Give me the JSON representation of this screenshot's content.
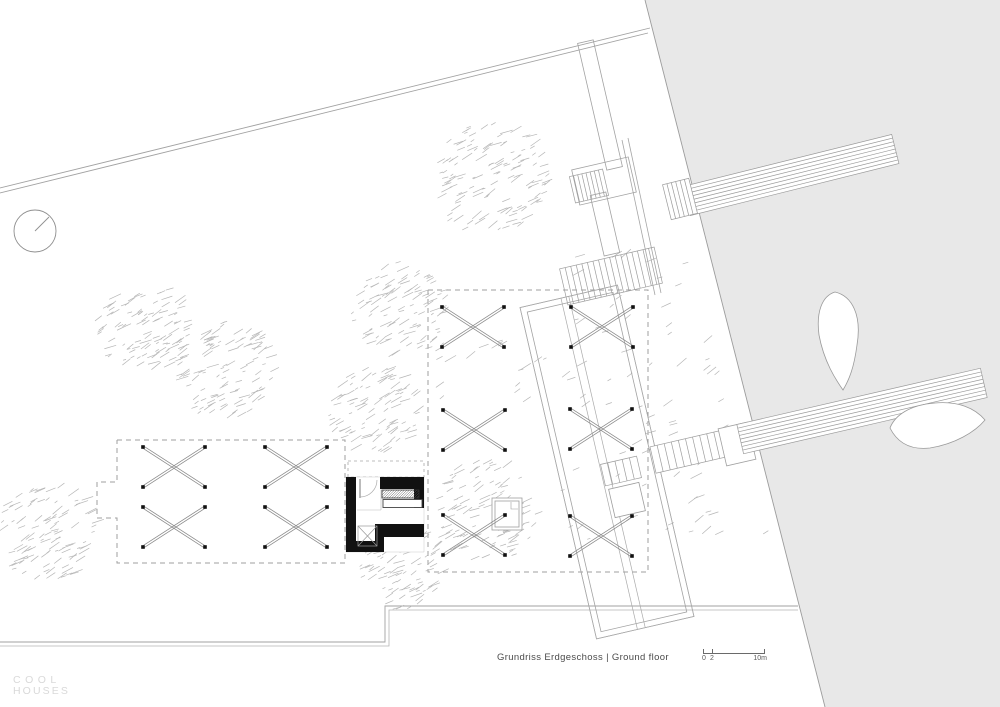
{
  "texts": {
    "caption": "Grundriss Erdgeschoss | Ground floor",
    "logo_line1": "COOL",
    "logo_line2": "HOUSES"
  },
  "scalebar": {
    "labels": [
      "0",
      "2",
      "10m"
    ]
  },
  "colors": {
    "paper": "#ffffff",
    "water": "#e8e8e8",
    "boundary": "#a2a2a2",
    "detail": "#a0a0a0",
    "dashed_zone": "#9f9f9f",
    "tree_hatch": "#b6b6b6",
    "wall_black": "#111111",
    "marker": "#8a8a8a",
    "marker_dot": "#111111",
    "caption_text": "#4b4b4b",
    "logo_text": "#d9d9d9",
    "scale_text": "#5a5a5a"
  },
  "plan": {
    "width": 1000,
    "height": 707,
    "shapes": [
      {
        "name": "water-area",
        "type": "poly",
        "pts": [
          [
            645,
            0
          ],
          [
            1000,
            0
          ],
          [
            1000,
            707
          ],
          [
            825,
            707
          ]
        ],
        "fill": "#e8e8e8",
        "stroke": "none"
      },
      {
        "name": "water-edge",
        "type": "line",
        "x1": 645,
        "y1": 0,
        "x2": 825,
        "y2": 707,
        "stroke": "#9c9c9c",
        "sw": 0.9
      },
      {
        "name": "site-boundary-top-outer",
        "type": "line",
        "x1": 0,
        "y1": 188,
        "x2": 650,
        "y2": 28,
        "stroke": "#a2a2a2",
        "sw": 0.9
      },
      {
        "name": "site-boundary-top-inner",
        "type": "line",
        "x1": 0,
        "y1": 193,
        "x2": 648,
        "y2": 33,
        "stroke": "#a2a2a2",
        "sw": 0.9
      },
      {
        "name": "site-boundary-bottom-outer",
        "type": "pline",
        "pts": [
          [
            0,
            642
          ],
          [
            385,
            642
          ],
          [
            385,
            606
          ],
          [
            798,
            606
          ]
        ],
        "stroke": "#a2a2a2",
        "sw": 0.9
      },
      {
        "name": "site-boundary-bottom-inner",
        "type": "pline",
        "pts": [
          [
            0,
            646
          ],
          [
            389,
            646
          ],
          [
            389,
            610
          ],
          [
            798,
            610
          ]
        ],
        "stroke": "#b5b5b5",
        "sw": 0.8
      },
      {
        "name": "terrace-zone-west-dashed",
        "type": "pline",
        "pts": [
          [
            117,
            440
          ],
          [
            345,
            440
          ],
          [
            345,
            563
          ],
          [
            117,
            563
          ],
          [
            117,
            518
          ],
          [
            97,
            518
          ],
          [
            97,
            482
          ],
          [
            117,
            482
          ],
          [
            117,
            440
          ]
        ],
        "stroke": "#9f9f9f",
        "sw": 1,
        "dash": "5,4"
      },
      {
        "name": "terrace-zone-east-dashed",
        "type": "pline",
        "pts": [
          [
            428,
            290
          ],
          [
            648,
            290
          ],
          [
            648,
            572
          ],
          [
            428,
            572
          ],
          [
            428,
            290
          ]
        ],
        "stroke": "#9f9f9f",
        "sw": 1,
        "dash": "5,4"
      },
      {
        "name": "canopy-dashed",
        "type": "pline",
        "pts": [
          [
            348,
            461
          ],
          [
            424,
            461
          ],
          [
            424,
            477
          ],
          [
            348,
            477
          ],
          [
            348,
            461
          ]
        ],
        "stroke": "#a8a8a8",
        "sw": 0.8,
        "dash": "3,3"
      },
      {
        "name": "tree",
        "type": "tree",
        "cx": 488,
        "cy": 180,
        "r": 58,
        "seed": 11,
        "n": 130
      },
      {
        "name": "tree",
        "type": "tree",
        "cx": 140,
        "cy": 328,
        "r": 46,
        "seed": 22,
        "n": 100
      },
      {
        "name": "tree",
        "type": "tree",
        "cx": 222,
        "cy": 370,
        "r": 50,
        "seed": 33,
        "n": 110
      },
      {
        "name": "tree",
        "type": "tree",
        "cx": 398,
        "cy": 310,
        "r": 48,
        "seed": 44,
        "n": 100
      },
      {
        "name": "tree",
        "type": "tree",
        "cx": 372,
        "cy": 412,
        "r": 45,
        "seed": 55,
        "n": 95
      },
      {
        "name": "tree",
        "type": "tree",
        "cx": 45,
        "cy": 532,
        "r": 50,
        "seed": 66,
        "n": 105
      },
      {
        "name": "tree",
        "type": "tree",
        "cx": 400,
        "cy": 570,
        "r": 42,
        "seed": 77,
        "n": 85
      },
      {
        "name": "tree",
        "type": "tree",
        "cx": 483,
        "cy": 513,
        "r": 52,
        "seed": 88,
        "n": 105
      },
      {
        "name": "slope-hatch",
        "type": "scatter",
        "x": 560,
        "y": 250,
        "w": 230,
        "h": 290,
        "seed": 99,
        "n": 110,
        "clip": [
          645,
          0.2546,
          6
        ]
      },
      {
        "name": "ground-hatch",
        "type": "scatter",
        "x": 430,
        "y": 335,
        "w": 120,
        "h": 70,
        "seed": 17,
        "n": 18
      },
      {
        "name": "retaining-line",
        "type": "line",
        "x1": 622,
        "y1": 140,
        "x2": 655,
        "y2": 295,
        "stroke": "#a5a5a5",
        "sw": 0.8
      },
      {
        "name": "retaining-line",
        "type": "line",
        "x1": 628,
        "y1": 138,
        "x2": 661,
        "y2": 293,
        "stroke": "#a5a5a5",
        "sw": 0.8
      },
      {
        "name": "walkway-upper",
        "type": "rect",
        "cx": 600,
        "cy": 105,
        "w": 16,
        "h": 130,
        "rot": -13,
        "stroke": "#a2a2a2",
        "sw": 0.8
      },
      {
        "name": "stair-landing-north",
        "type": "rect",
        "cx": 604,
        "cy": 181,
        "w": 58,
        "h": 36,
        "rot": -13,
        "stroke": "#a2a2a2",
        "sw": 0.8
      },
      {
        "name": "stair-flight-north",
        "type": "stairs",
        "cx": 589,
        "cy": 186,
        "w": 34,
        "h": 27,
        "rot": -13,
        "treads": 8,
        "stroke": "#9d9d9d",
        "sw": 0.7
      },
      {
        "name": "walkway-mid",
        "type": "rect",
        "cx": 605,
        "cy": 224,
        "w": 16,
        "h": 62,
        "rot": -13,
        "stroke": "#a2a2a2",
        "sw": 0.8
      },
      {
        "name": "stair-flight-main",
        "type": "stairs",
        "cx": 611,
        "cy": 276,
        "w": 97,
        "h": 37,
        "rot": -13,
        "treads": 17,
        "stroke": "#9d9d9d",
        "sw": 0.7
      },
      {
        "name": "deck-outline",
        "type": "rect",
        "cx": 607,
        "cy": 462,
        "w": 100,
        "h": 340,
        "rot": -13,
        "inset": 6,
        "stroke": "#a2a2a2",
        "sw": 0.8
      },
      {
        "name": "deck-walkway-lines",
        "type": "pierv",
        "cx": 607,
        "cy": 462,
        "w": 100,
        "h": 340,
        "rot": -13,
        "offs": [
          -8,
          0
        ],
        "stroke": "#aaaaaa",
        "sw": 0.7
      },
      {
        "name": "stair-flight-pier",
        "type": "stairs",
        "cx": 692,
        "cy": 451,
        "w": 80,
        "h": 27,
        "rot": -13,
        "treads": 11,
        "fill": "#ffffff",
        "stroke": "#9d9d9d",
        "sw": 0.7
      },
      {
        "name": "pier-landing",
        "type": "rect",
        "cx": 737,
        "cy": 444,
        "w": 30,
        "h": 38,
        "rot": -13,
        "fill": "#ffffff",
        "stroke": "#a0a0a0",
        "sw": 0.8
      },
      {
        "name": "pier-south",
        "type": "pier",
        "cx": 862,
        "cy": 411,
        "w": 250,
        "h": 30,
        "rot": -13,
        "lines": 7,
        "fill": "#ffffff",
        "stroke": "#9a9a9a",
        "sw": 0.7
      },
      {
        "name": "pier-north",
        "type": "pier",
        "cx": 791,
        "cy": 175,
        "w": 215,
        "h": 30,
        "rot": -14,
        "lines": 7,
        "fill": "#ffffff",
        "stroke": "#9a9a9a",
        "sw": 0.7
      },
      {
        "name": "gangway",
        "type": "stairs",
        "cx": 680,
        "cy": 199,
        "w": 27,
        "h": 36,
        "rot": -14,
        "treads": 6,
        "fill": "#ffffff",
        "stroke": "#9a9a9a",
        "sw": 0.7
      },
      {
        "name": "stair-flight-small",
        "type": "stairs",
        "cx": 621,
        "cy": 471,
        "w": 37,
        "h": 22,
        "rot": -13,
        "treads": 5,
        "stroke": "#9d9d9d",
        "sw": 0.7
      },
      {
        "name": "pavilion-square",
        "type": "rect",
        "cx": 627,
        "cy": 500,
        "w": 31,
        "h": 29,
        "rot": -13,
        "fill": "#ffffff",
        "stroke": "#9d9d9d",
        "sw": 0.8
      },
      {
        "name": "boat",
        "type": "path",
        "d": "M835,292 C852,296 862,315 857,345 C854,368 849,380 843,390 C836,380 824,362 819,335 C816,312 822,296 835,292 Z",
        "fill": "#ffffff",
        "stroke": "#9a9a9a",
        "sw": 0.8
      },
      {
        "name": "boat",
        "type": "path",
        "d": "M890,428 C895,415 910,405 935,403 C958,401 975,408 985,420 C975,432 955,444 930,448 C912,450 898,444 890,428 Z",
        "fill": "#ffffff",
        "stroke": "#9a9a9a",
        "sw": 0.8
      },
      {
        "name": "kiosk-floor",
        "type": "poly",
        "pts": [
          [
            346,
            477
          ],
          [
            424,
            477
          ],
          [
            424,
            552
          ],
          [
            346,
            552
          ]
        ],
        "fill": "#ffffff",
        "stroke": "#c9c9c9",
        "sw": 0.5
      },
      {
        "name": "small-pavilion",
        "type": "rect",
        "cx": 507,
        "cy": 514,
        "w": 30,
        "h": 32,
        "rot": 0,
        "inset": 3,
        "fill": "#ffffff",
        "stroke": "#9d9d9d",
        "sw": 0.8
      },
      {
        "name": "small-pavilion-notch",
        "type": "pline",
        "pts": [
          [
            511,
            502
          ],
          [
            511,
            509
          ],
          [
            518,
            509
          ]
        ],
        "stroke": "#9d9d9d",
        "sw": 0.6
      },
      {
        "name": "kiosk-wall-left",
        "type": "rect",
        "cx": 351,
        "cy": 514.5,
        "w": 10,
        "h": 75,
        "rot": 0,
        "fill": "#111111",
        "stroke": "none"
      },
      {
        "name": "kiosk-wall-top",
        "type": "rect",
        "cx": 402,
        "cy": 483,
        "w": 44,
        "h": 12,
        "rot": 0,
        "fill": "#111111",
        "stroke": "none"
      },
      {
        "name": "kiosk-wall-right",
        "type": "rect",
        "cx": 419,
        "cy": 492.5,
        "w": 10,
        "h": 31,
        "rot": 0,
        "fill": "#111111",
        "stroke": "none"
      },
      {
        "name": "kiosk-wall-L-horiz",
        "type": "rect",
        "cx": 399.5,
        "cy": 530.5,
        "w": 49,
        "h": 13,
        "rot": 0,
        "fill": "#111111",
        "stroke": "none"
      },
      {
        "name": "kiosk-wall-L-vert",
        "type": "rect",
        "cx": 379.5,
        "cy": 538,
        "w": 9,
        "h": 28,
        "rot": 0,
        "fill": "#111111",
        "stroke": "none"
      },
      {
        "name": "kiosk-wall-bottom",
        "type": "rect",
        "cx": 365,
        "cy": 546.5,
        "w": 38,
        "h": 11,
        "rot": 0,
        "fill": "#111111",
        "stroke": "none"
      },
      {
        "name": "kiosk-counter-hatched",
        "type": "hrect",
        "x": 382,
        "y": 490,
        "w": 37,
        "h": 8,
        "stroke": "#555555",
        "sw": 0.5
      },
      {
        "name": "kiosk-counter",
        "type": "rect",
        "cx": 402.5,
        "cy": 503.5,
        "w": 39,
        "h": 8,
        "rot": 0,
        "fill": "#ffffff",
        "stroke": "#444444",
        "sw": 0.9
      },
      {
        "name": "kiosk-shaft",
        "type": "rectx",
        "cx": 367.5,
        "cy": 536,
        "w": 19,
        "h": 20,
        "stroke": "#999999",
        "sw": 0.7
      },
      {
        "name": "kiosk-door-leaf",
        "type": "line",
        "x1": 360,
        "y1": 479,
        "x2": 360,
        "y2": 498,
        "stroke": "#777777",
        "sw": 1
      },
      {
        "name": "kiosk-door-swing",
        "type": "path",
        "d": "M377,480 A17,17 0 0 1 360,497",
        "fill": "none",
        "stroke": "#ababab",
        "sw": 0.7
      },
      {
        "name": "kiosk-interior-line",
        "type": "line",
        "x1": 357,
        "y1": 510,
        "x2": 381,
        "y2": 510,
        "stroke": "#bbbbbb",
        "sw": 0.6
      },
      {
        "name": "kiosk-interior-line",
        "type": "line",
        "x1": 381,
        "y1": 489,
        "x2": 381,
        "y2": 510,
        "stroke": "#bbbbbb",
        "sw": 0.6
      },
      {
        "name": "shade-marker",
        "type": "x",
        "cx": 174,
        "cy": 467
      },
      {
        "name": "shade-marker",
        "type": "x",
        "cx": 296,
        "cy": 467
      },
      {
        "name": "shade-marker",
        "type": "x",
        "cx": 174,
        "cy": 527
      },
      {
        "name": "shade-marker",
        "type": "x",
        "cx": 296,
        "cy": 527
      },
      {
        "name": "shade-marker",
        "type": "x",
        "cx": 473,
        "cy": 327
      },
      {
        "name": "shade-marker",
        "type": "x",
        "cx": 602,
        "cy": 327
      },
      {
        "name": "shade-marker",
        "type": "x",
        "cx": 474,
        "cy": 430
      },
      {
        "name": "shade-marker",
        "type": "x",
        "cx": 601,
        "cy": 429
      },
      {
        "name": "shade-marker",
        "type": "x",
        "cx": 474,
        "cy": 535
      },
      {
        "name": "shade-marker",
        "type": "x",
        "cx": 601,
        "cy": 536
      },
      {
        "name": "north-symbol-circle",
        "type": "circle",
        "cx": 35,
        "cy": 231,
        "r": 21,
        "stroke": "#8f8f8f",
        "sw": 0.9
      },
      {
        "name": "north-symbol-needle",
        "type": "line",
        "x1": 35,
        "y1": 231,
        "x2": 49,
        "y2": 217,
        "stroke": "#8f8f8f",
        "sw": 0.9
      }
    ]
  }
}
